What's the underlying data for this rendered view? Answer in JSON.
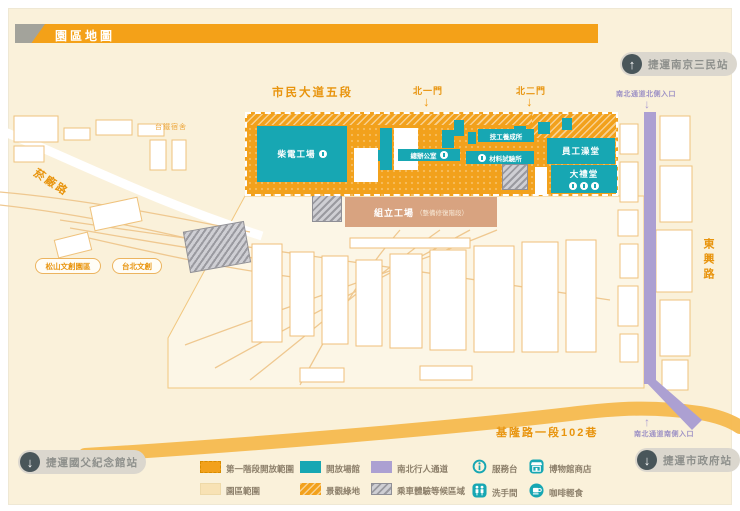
{
  "title": "園區地圖",
  "stations": {
    "nanjing_sanmin": "捷運南京三民站",
    "syt_memorial": "捷運國父紀念館站",
    "city_hall": "捷運市政府站"
  },
  "roads": {
    "civic_blvd": "市民大道五段",
    "dongxing": "東興路",
    "keelung_lane": "基隆路一段102巷",
    "yanchang": "菸廠路"
  },
  "gates": {
    "north1": "北一門",
    "north2": "北二門"
  },
  "passage": {
    "north_entrance": "南北通道北側入口",
    "south_entrance": "南北通道南側入口"
  },
  "nearby": {
    "tra_dorm": "台鐵宿舍",
    "songshan_park": "松山文創園區",
    "taipei_creative": "台北文創"
  },
  "buildings": {
    "diesel_workshop": "柴電工場",
    "general_office": "總辦公室",
    "training_institute": "技工養成所",
    "material_lab": "材料試驗所",
    "staff_bath": "員工澡堂",
    "auditorium": "大禮堂",
    "assembly_workshop": "組立工場",
    "assembly_note": "（整備修復階段）"
  },
  "legend": {
    "areas": [
      {
        "label": "第一階段開放範圍",
        "color": "#F2A11C",
        "style": "orange-dashed"
      },
      {
        "label": "開放場館",
        "color": "#17A7B3",
        "style": "teal-solid"
      },
      {
        "label": "南北行人通道",
        "color": "#ACA0D2",
        "style": "purple-solid"
      },
      {
        "label": "園區範圍",
        "color": "#F8E2B4",
        "style": "cream-solid"
      },
      {
        "label": "景觀綠地",
        "color": "#F2A11C",
        "style": "orange-hatch"
      },
      {
        "label": "乘車體驗等候區域",
        "color": "#9B9B9B",
        "style": "gray-hatch"
      }
    ],
    "facilities": [
      {
        "label": "服務台",
        "icon": "info-icon"
      },
      {
        "label": "博物館商店",
        "icon": "shop-icon"
      },
      {
        "label": "洗手間",
        "icon": "restroom-icon"
      },
      {
        "label": "咖啡輕食",
        "icon": "coffee-icon"
      }
    ]
  },
  "colors": {
    "banner_orange": "#F4A118",
    "phase_orange": "#F2A11C",
    "venue_teal": "#17A7B3",
    "passage_purple": "#ACA0D2",
    "park_cream": "#FAF1DA",
    "assembly_tan": "#D8A380",
    "road_label_orange": "#E8940D",
    "pill_gray": "#DBD7CE",
    "pill_circle_gray": "#49565A"
  }
}
